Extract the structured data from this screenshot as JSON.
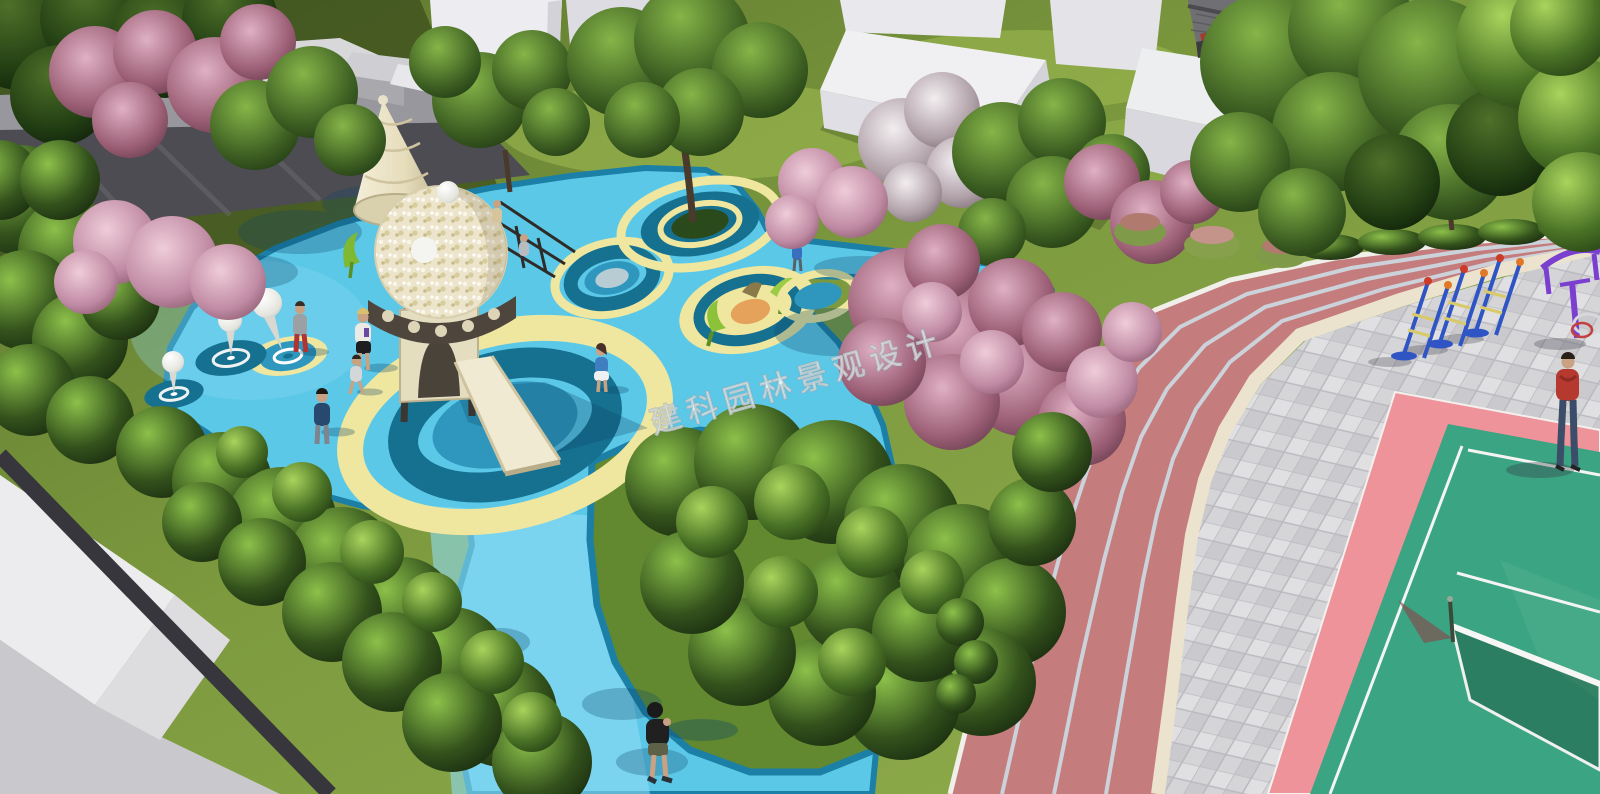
{
  "watermark": {
    "text": "建科园林景观设计"
  },
  "palette": {
    "grass": "#7f9c42",
    "grass_shadow": "#43581f",
    "playground_blue": "#5cc8e8",
    "playground_blue_light": "#8edcf4",
    "playground_edge": "#1b7fa6",
    "ring_yellow": "#efe6a0",
    "ring_teal": "#15718f",
    "ring_blue": "#2f97bd",
    "track_red": "#c47c7c",
    "track_line": "#ccd2da",
    "curb_cream": "#ece3cf",
    "plaza_gray": "#d5d5d8",
    "court_pink": "#ee939a",
    "court_green": "#3aa483",
    "court_line": "#f4f4f2",
    "building_white": "#ededf1",
    "blossom_pink": "#c08ba4",
    "structure_cream": "#eae3c8",
    "equipment_blue": "#2f55c4",
    "equipment_purple": "#7b3fd0",
    "balloon_white": "#efefec"
  },
  "scene": {
    "type": "3d-landscape-architecture-render",
    "elements": [
      "kindergarten playground with blue EVA surface and concentric circle motifs",
      "cream cone-and-dome slide tower with climbing kids",
      "white teardrop balloon sculptures on target circles",
      "tree planted inside ringed circle",
      "green trumpet play sculptures on yellow circle",
      "curved red 4-lane running track with gray lane lines",
      "gray paved plaza with diagonal tile pattern",
      "green sport court with pink surround and net",
      "outdoor fitness equipment, blue and purple",
      "white massing-model buildings and chinese tile-roof pavilion",
      "pink blossom trees, green trees, dense shrubs",
      "gray flat-roof building in bottom-left corner"
    ],
    "people": [
      "adult in gray top and red pants",
      "woman in white top and black skirt",
      "running child",
      "man in navy shirt seen from behind",
      "girl in blue top and white skirt",
      "two children climbing the slide tower",
      "boy in black t-shirt walking on blue path",
      "child on blue walkway",
      "adult in red hoodie and jeans on plaza"
    ]
  }
}
